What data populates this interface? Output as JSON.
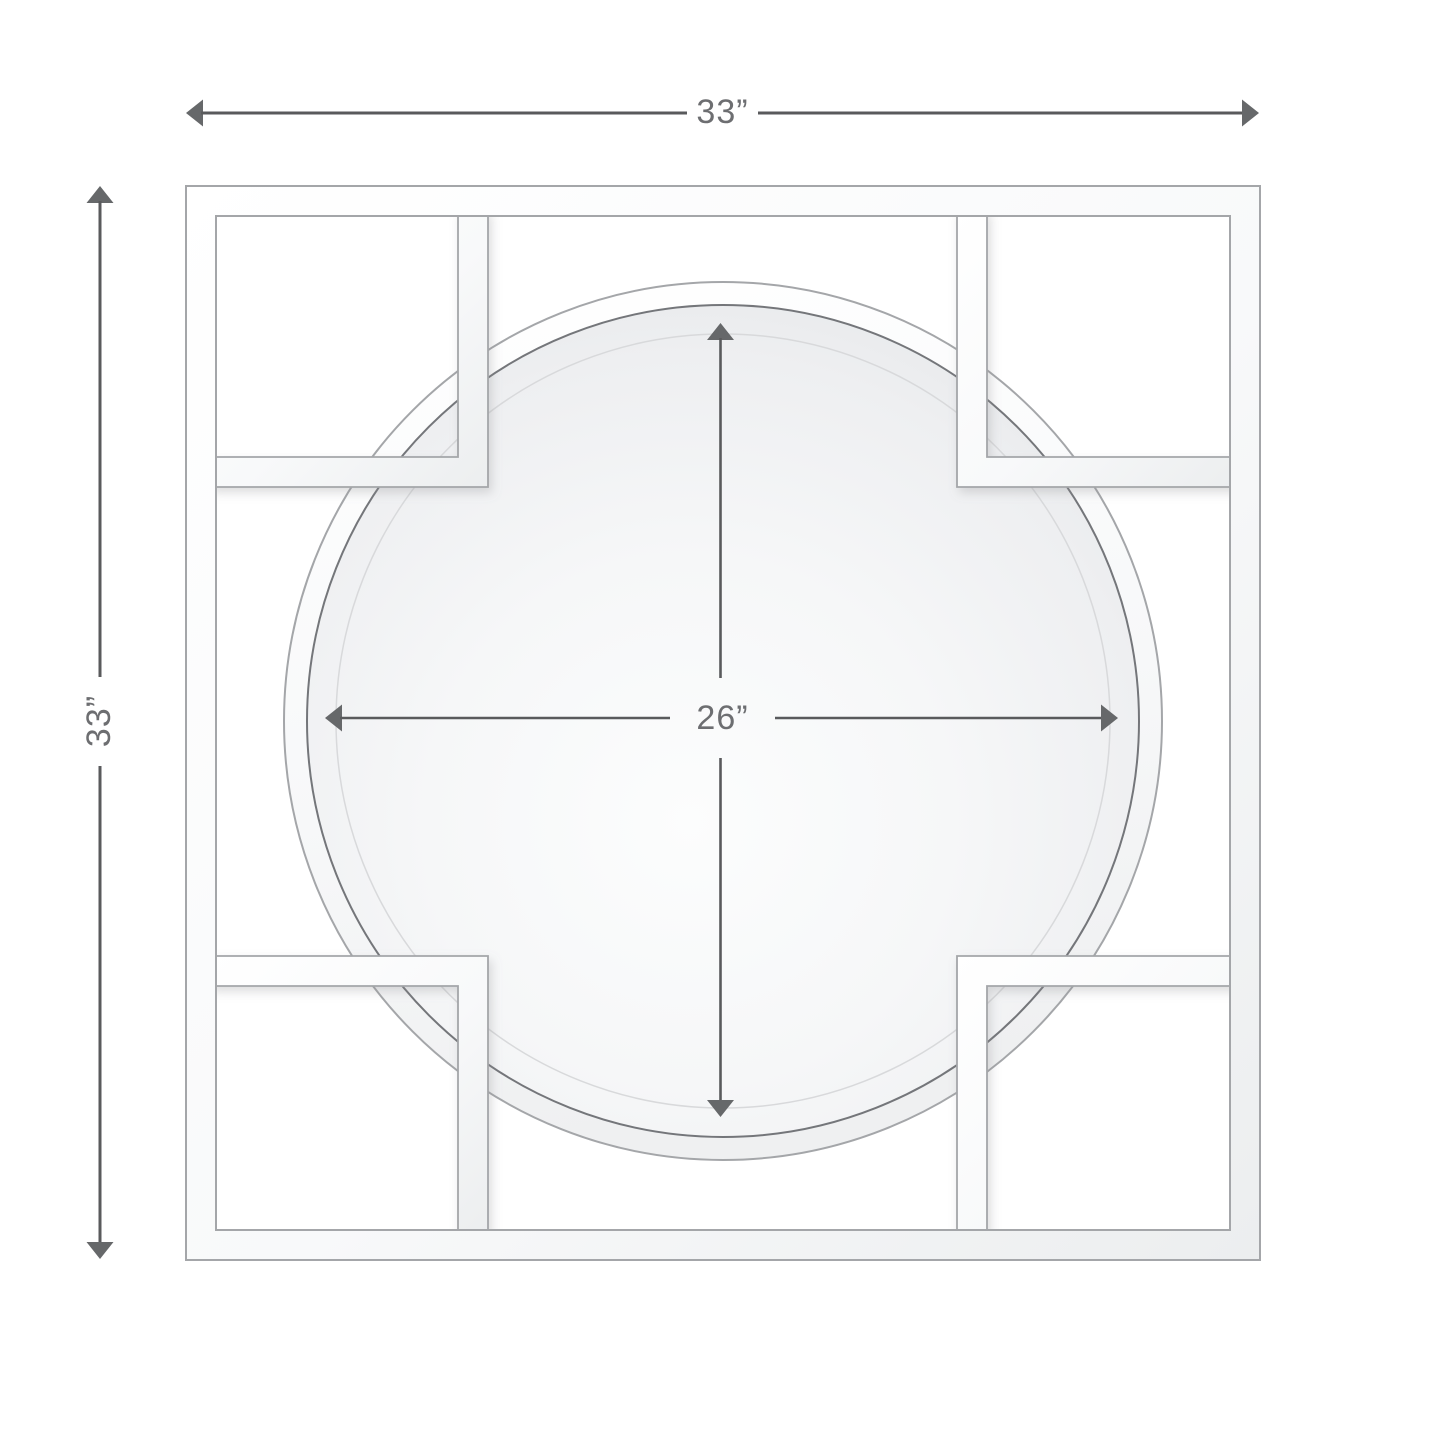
{
  "figure": {
    "name": "square-openwork-frame-round-mirror-dimension-diagram",
    "labels": {
      "overall_width": "33”",
      "overall_height": "33”",
      "mirror_diameter": "26”"
    },
    "values": {
      "overall_width_inches": 33,
      "overall_height_inches": 33,
      "mirror_diameter_inches": 26,
      "unit": "inches"
    },
    "colors": {
      "background": "#ffffff",
      "dimension_line": "#595a5c",
      "dimension_arrow": "#66686a",
      "dimension_text": "#6d6e71",
      "frame_outline": "#a4a6a9",
      "frame_fill": "#f7f8f9",
      "mirror_bevel_edge": "#74767a",
      "mirror_glass": "#eef0f2"
    }
  }
}
